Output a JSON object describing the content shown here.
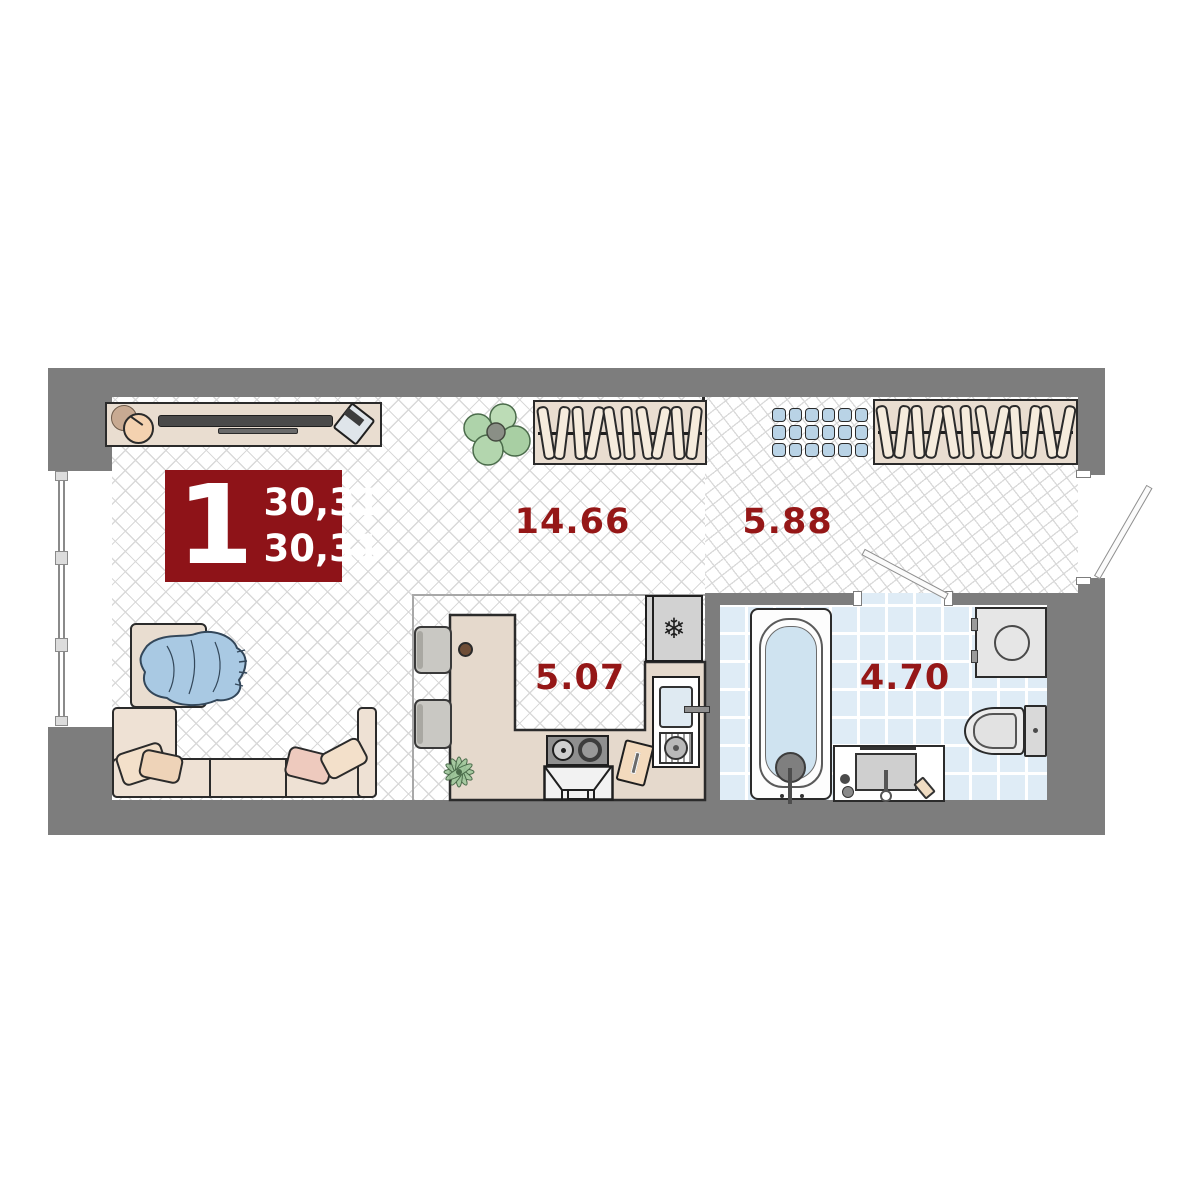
{
  "plan": {
    "badge": {
      "rooms": "1",
      "total_area": "30,31",
      "living_area": "30,31"
    },
    "zones": [
      {
        "name": "living-room",
        "area": "14.66"
      },
      {
        "name": "hallway",
        "area": "5.88"
      },
      {
        "name": "kitchen",
        "area": "5.07"
      },
      {
        "name": "bathroom",
        "area": "4.70"
      }
    ],
    "icons": {
      "fridge": "❄"
    },
    "colors": {
      "wall": "#7d7d7d",
      "accent_red": "#8e1318",
      "label_red": "#951717",
      "furniture_beige": "#e9ddd0",
      "tile_blue": "#dfecf6",
      "shoe_rack_blue": "#b9d3e6",
      "blanket_blue": "#a9c9e3"
    }
  }
}
